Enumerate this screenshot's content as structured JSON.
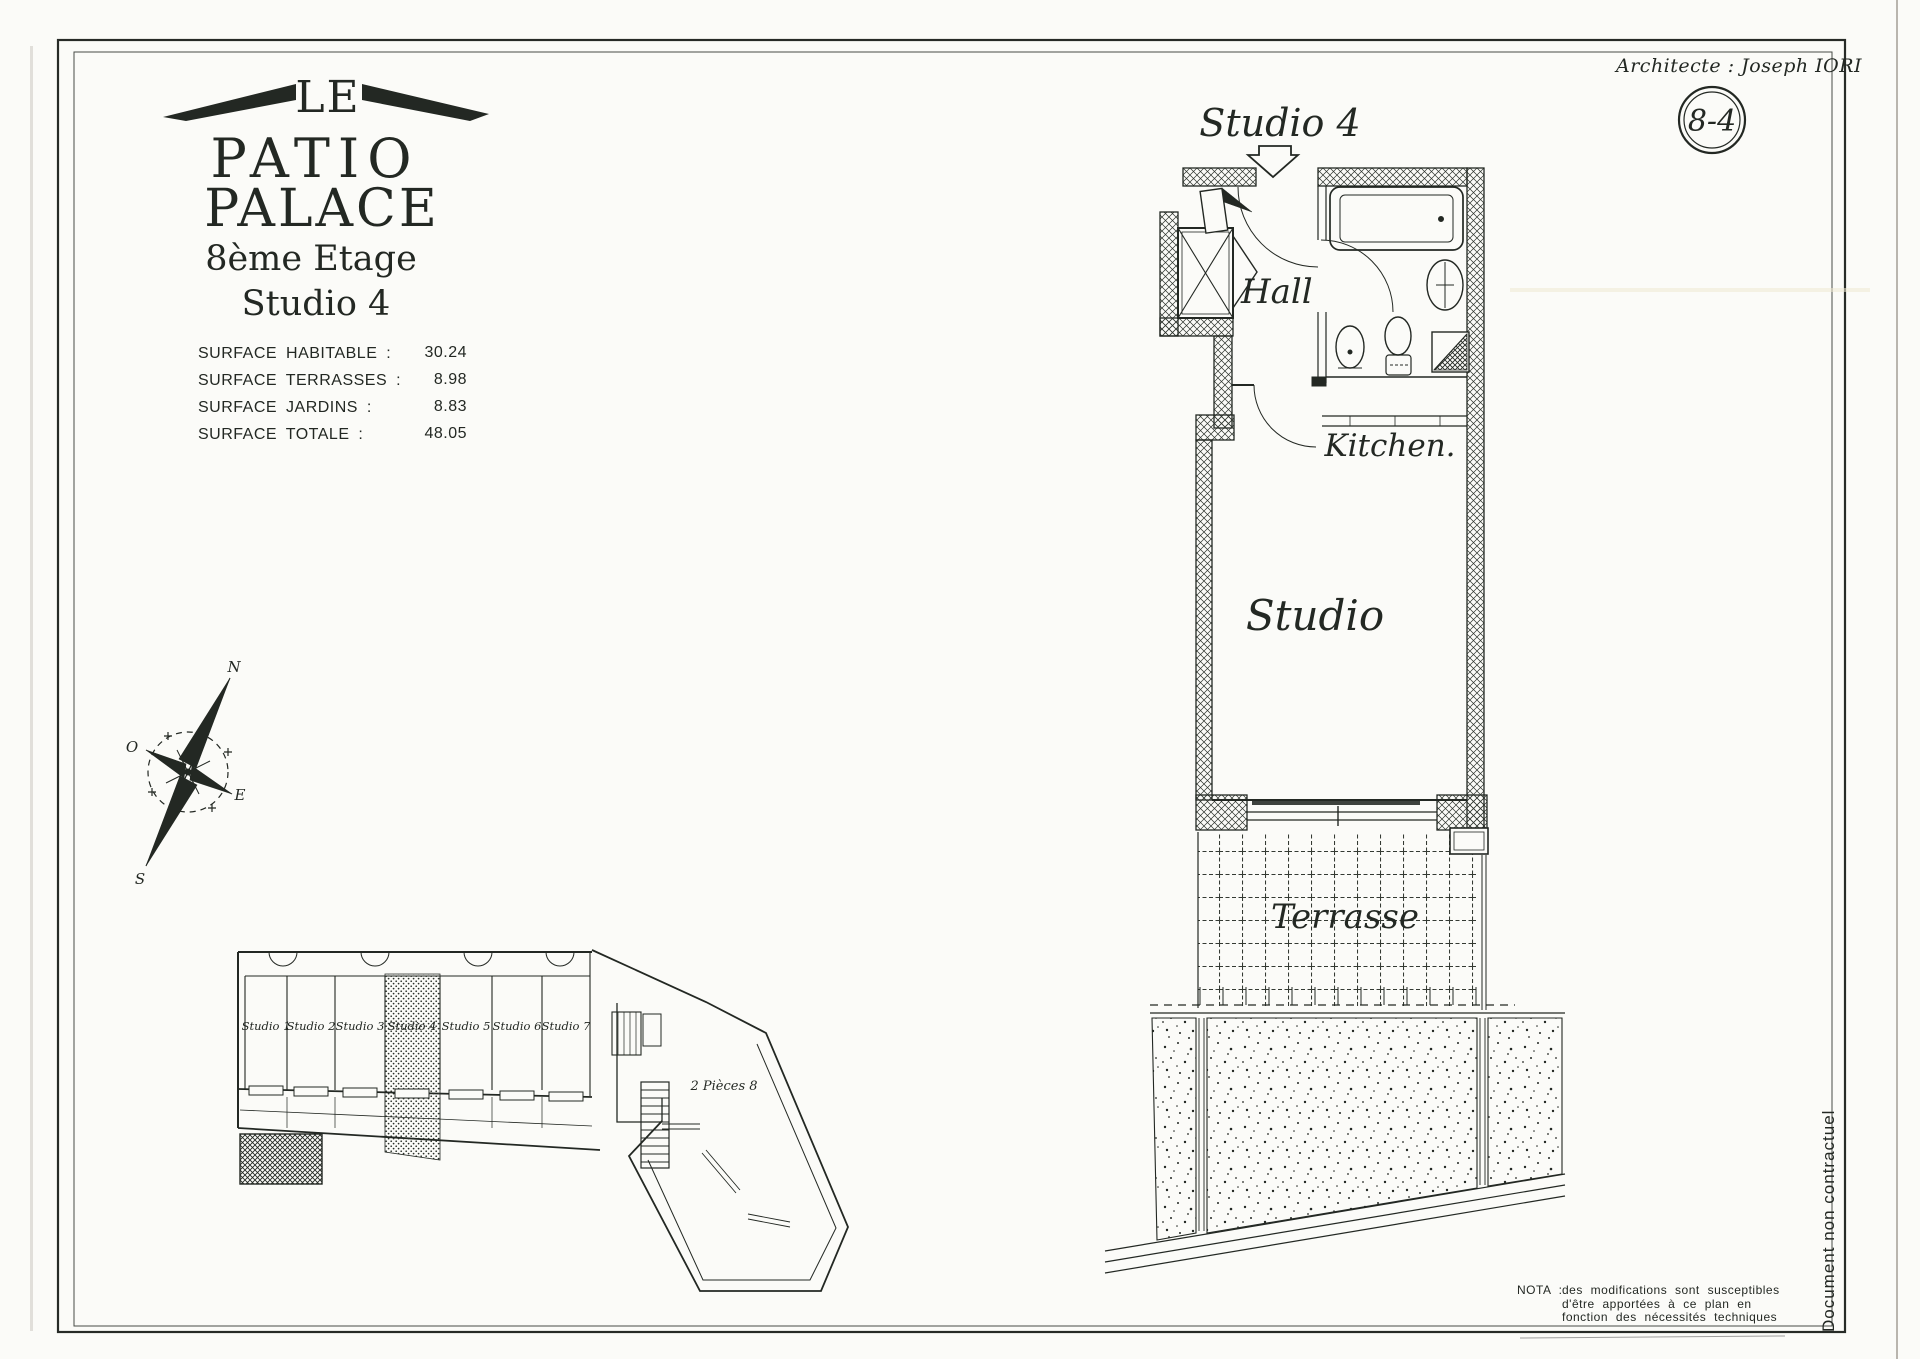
{
  "ink_color": "#232823",
  "header": {
    "architect": "Architecte : Joseph  IORI",
    "plan_ref": "8-4"
  },
  "logo": {
    "le": "LE",
    "patio": "PATIO",
    "palace": "PALACE",
    "floor": "8ème Etage",
    "unit": "Studio 4"
  },
  "surface_table": {
    "rows": [
      {
        "label": "SURFACE  HABITABLE  :",
        "value": "30.24"
      },
      {
        "label": "SURFACE  TERRASSES  :",
        "value": "8.98"
      },
      {
        "label": "SURFACE  JARDINS  :",
        "value": "8.83"
      },
      {
        "label": "SURFACE  TOTALE  :",
        "value": "48.05"
      }
    ]
  },
  "compass": {
    "north": "N",
    "south": "S",
    "east": "E",
    "west": "O"
  },
  "main_plan": {
    "title": "Studio 4",
    "hall": "Hall",
    "kitchen": "Kitchen.",
    "studio": "Studio",
    "terrace": "Terrasse"
  },
  "key_plan": {
    "units": [
      "Studio 1",
      "Studio 2",
      "Studio 3",
      "Studio 4",
      "Studio 5",
      "Studio 6",
      "Studio 7"
    ],
    "apartment": "2 Pièces 8"
  },
  "nota": {
    "label": "NOTA :",
    "line1": "des  modifications  sont  susceptibles",
    "line2": "d'être  apportées  à  ce  plan  en",
    "line3": "fonction  des  nécessités  techniques"
  },
  "side_note": "Document  non  contractuel"
}
